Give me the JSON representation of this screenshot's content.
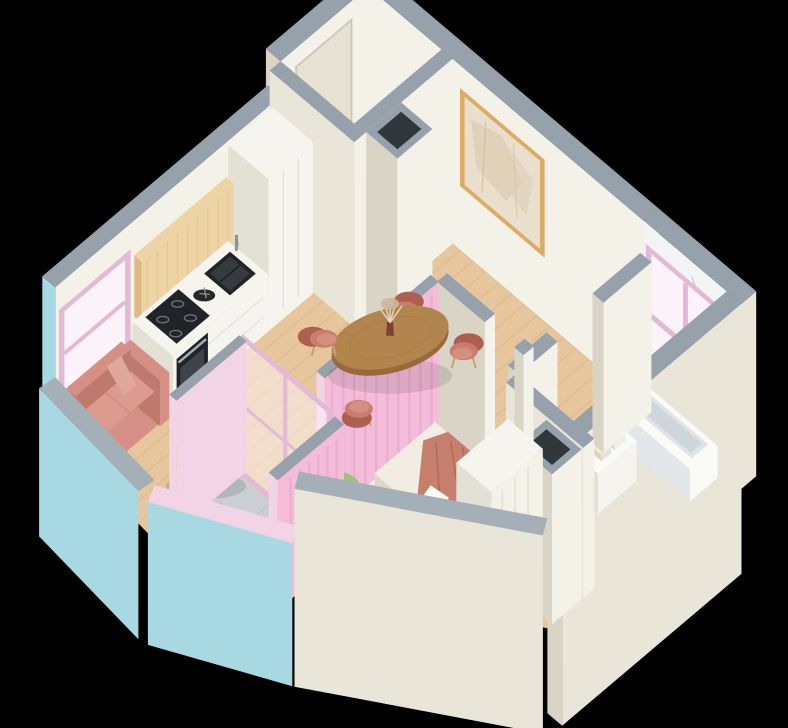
{
  "scene": {
    "type": "isometric-apartment-render",
    "background": "#000000",
    "description": "Cutaway isometric 3D render of a studio apartment floor plan"
  },
  "rooms": [
    {
      "name": "entry-hall"
    },
    {
      "name": "kitchen"
    },
    {
      "name": "living-dining-area"
    },
    {
      "name": "bedroom"
    },
    {
      "name": "bathroom"
    },
    {
      "name": "balcony"
    }
  ],
  "furniture": [
    "kitchen cabinets",
    "sink",
    "induction cooktop",
    "oven",
    "dining table",
    "four dining chairs",
    "vase with pampas grass",
    "wall art",
    "sofa",
    "coffee table",
    "bed",
    "blanket",
    "pillows",
    "wardrobe",
    "potted plant",
    "bathtub",
    "vanity with towels",
    "ventilation shafts",
    "pink framed windows",
    "balcony glazing"
  ],
  "colors": {
    "bg": "#000000",
    "wallTop": "#96a1ab",
    "wallTopLight": "#a5afb8",
    "wallCream": "#e9e5d9",
    "wallCreamLight": "#f4f1e8",
    "wallCreamDark": "#d9d4c6",
    "doorCream": "#e6e1d3",
    "counterWhite": "#f6f4ee",
    "counterSide": "#e3e0d6",
    "blue": "#a8d8e2",
    "pink": "#f3d4e6",
    "pinkBright": "#f5bcda",
    "pinkStripe": "#e5a9ca",
    "pinkFrame": "#e2bad5",
    "pinkGlass": "#fdf3fa",
    "woodFloor": "#e7c69d",
    "woodFloorLine": "#d5ae7e",
    "woodPanel": "#eed3a4",
    "woodPanelLine": "#dcba86",
    "appliance": "#202327",
    "applianceLight": "#3f444a",
    "steel": "#8b939c",
    "tableWood": "#b2854f",
    "tableWoodDark": "#97693b",
    "chair": "#c87d6e",
    "chairDark": "#ae6050",
    "chairSeat": "#d38f80",
    "chairLeg": "#c8a276",
    "sofa": "#d68f84",
    "sofaDark": "#bf7a6e",
    "sofaCushion": "#dd9a8e",
    "linen": "#f1ede3",
    "linenShadow": "#ddd7c8",
    "blanket": "#c67e6d",
    "blanketDark": "#b06a59",
    "pillow": "#ce8676",
    "white": "#fafaf7",
    "marble": "#f3f4f6",
    "marbleVein": "#c6cbd3",
    "marbleFloor": "#edeff2",
    "tile": "#cbcfd4",
    "tileLine": "#bcc1c6",
    "plantDark": "#6f9b4e",
    "plantLight": "#97c473",
    "potBrown": "#8a6a4f",
    "frameGold": "#dcab66",
    "artBeige": "#eadfcc",
    "artSmudge": "#d8c3a6",
    "shaftDark": "#31363b"
  }
}
